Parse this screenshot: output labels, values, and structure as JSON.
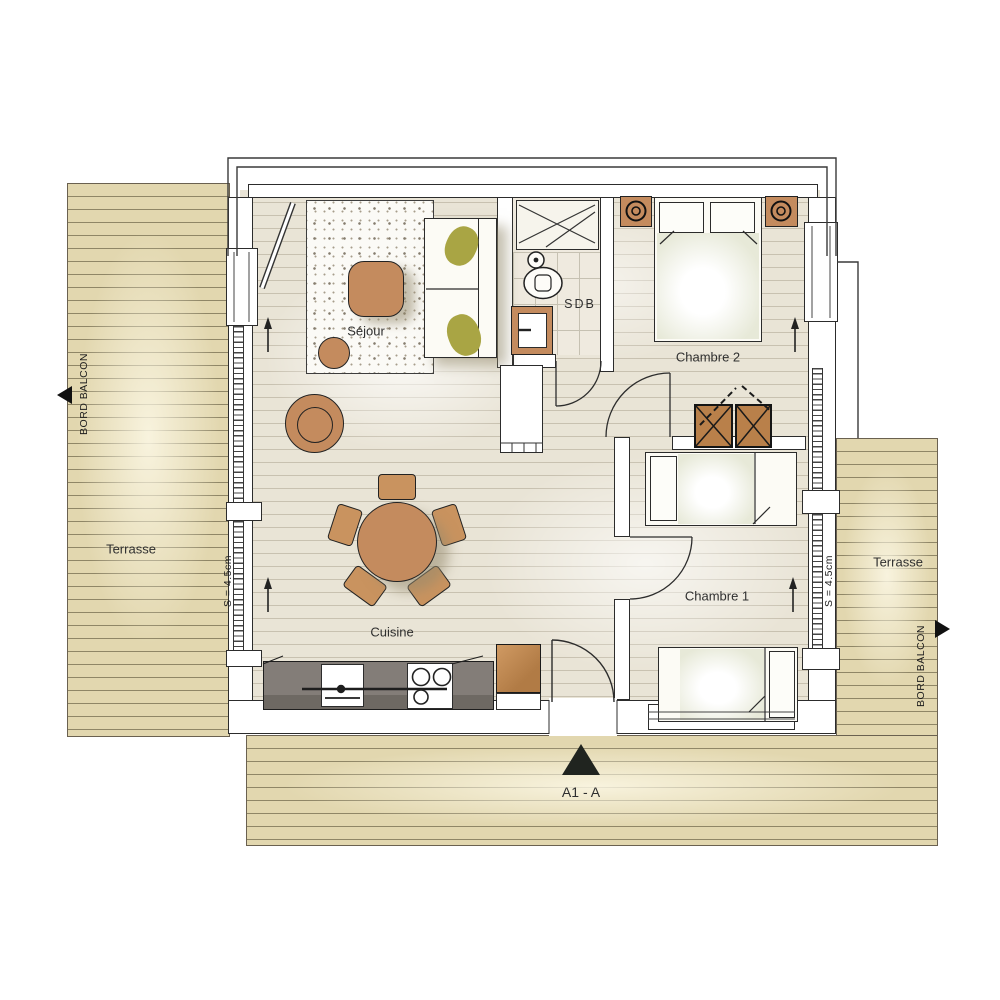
{
  "plan_title": "Apartment floor plan",
  "rooms": {
    "sejour": "Séjour",
    "cuisine": "Cuisine",
    "sdb": "SDB",
    "chambre1": "Chambre 1",
    "chambre2": "Chambre 2"
  },
  "outdoor": {
    "terrasse_left": "Terrasse",
    "terrasse_right": "Terrasse",
    "bord_balcon_left": "BORD BALCON",
    "bord_balcon_right": "BORD BALCON"
  },
  "annotations": {
    "slope_left": "S = 4.5cm",
    "slope_right": "S = 4.5cm",
    "section_marker": "A1 - A"
  },
  "icons": {
    "direction_arrow": "flooring-direction-arrow",
    "balcony_edge_arrow": "balcony-edge-triangle",
    "section_triangle": "section-cut-triangle"
  },
  "colors": {
    "furniture_wood": "#c48b5e",
    "terrace_deck": "#e2d7af",
    "interior_floor": "#e9e4d6",
    "kitchen_counter": "#7d7772",
    "wall_line": "#2c2c2c",
    "pillow_olive": "#a9a544",
    "marker_black": "#20241f"
  }
}
